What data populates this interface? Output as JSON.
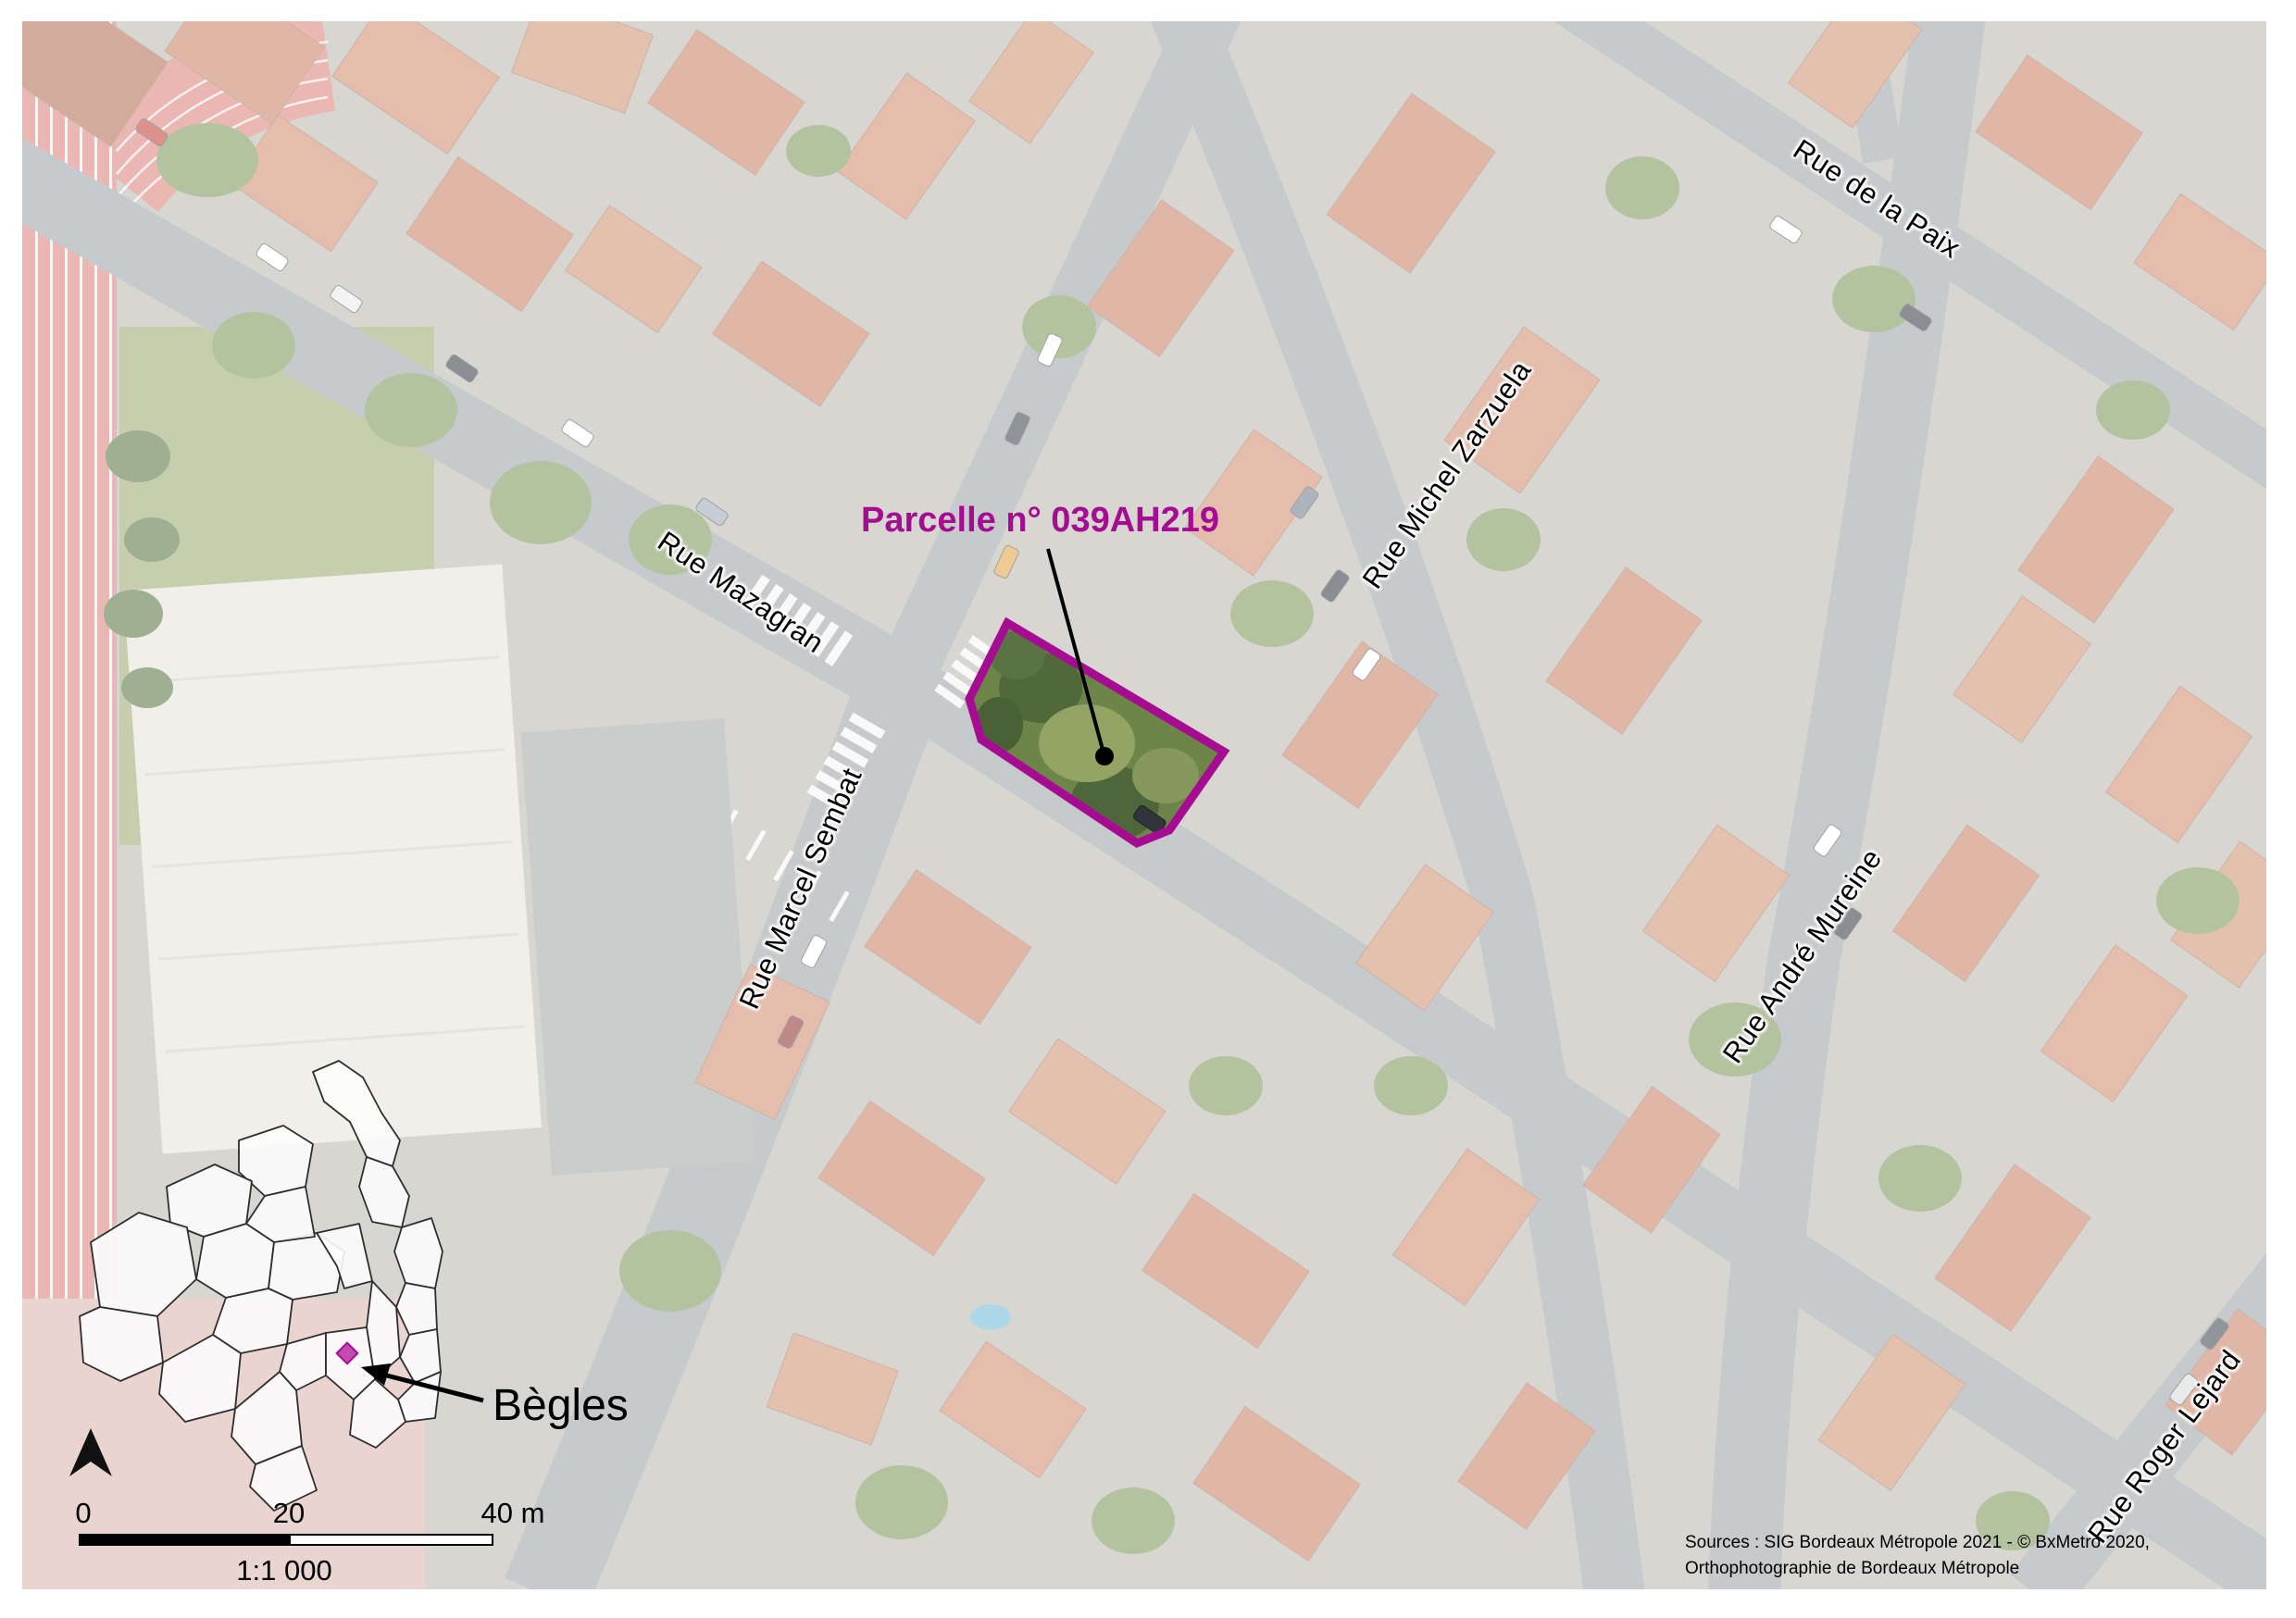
{
  "map": {
    "parcel_label": "Parcelle n° 039AH219",
    "parcel_outline_color": "#A50C92",
    "streets": [
      {
        "name": "Rue Mazagran"
      },
      {
        "name": "Rue Marcel Sembat"
      },
      {
        "name": "Rue Michel Zarzuela"
      },
      {
        "name": "Rue de la Paix"
      },
      {
        "name": "Rue André Mureine"
      },
      {
        "name": "Rue Roger Lejard"
      }
    ],
    "inset": {
      "label": "Bègles",
      "marker_color": "#C24CB2"
    },
    "scalebar": {
      "tick_0": "0",
      "tick_20": "20",
      "tick_40": "40 m",
      "scale_ratio": "1:1 000"
    },
    "sources": {
      "line1": "Sources : SIG Bordeaux Métropole 2021 - © BxMetro 2020,",
      "line2": "Orthophotographie de Bordeaux Métropole"
    }
  }
}
